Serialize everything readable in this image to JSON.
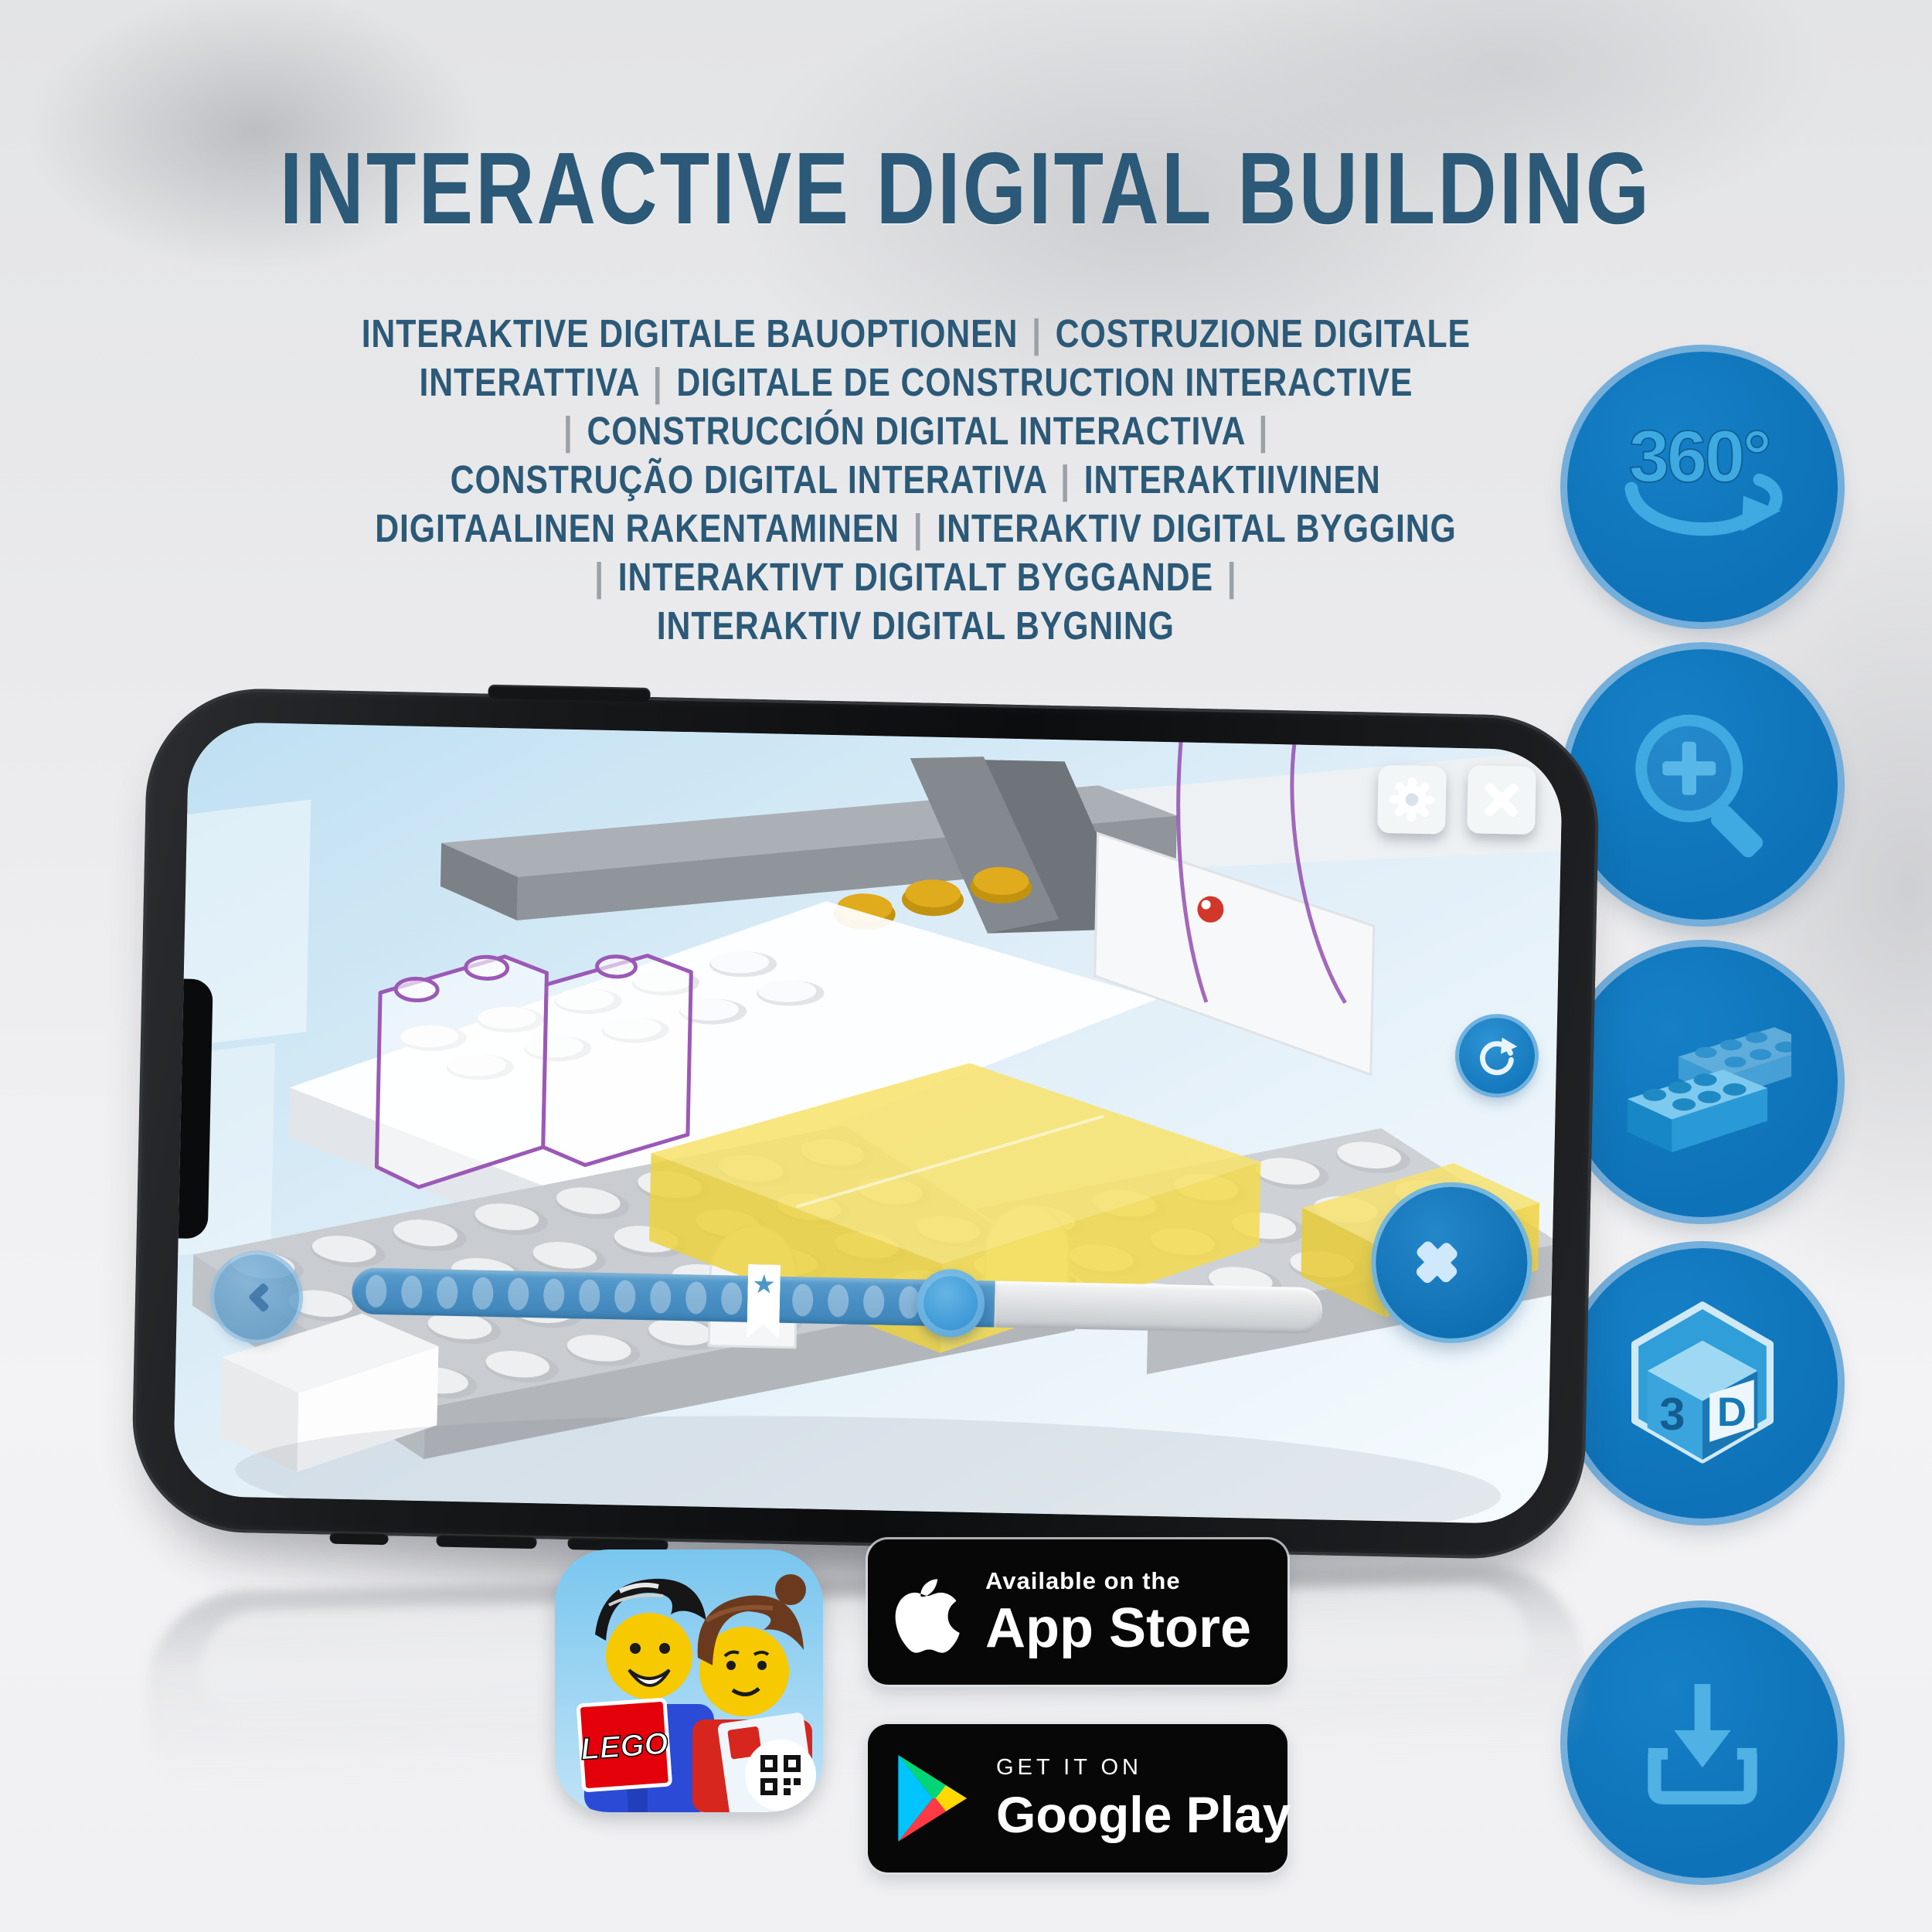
{
  "header": {
    "title": "INTERACTIVE DIGITAL BUILDING",
    "subtitle_lines": [
      "INTERAKTIVE DIGITALE BAUOPTIONEN | COSTRUZIONE DIGITALE",
      "INTERATTIVA | DIGITALE DE CONSTRUCTION INTERACTIVE",
      "| CONSTRUCCIÓN DIGITAL INTERACTIVA |",
      "CONSTRUÇÃO DIGITAL INTERATIVA | INTERAKTIIVINEN",
      "DIGITAALINEN RAKENTAMINEN | INTERAKTIV DIGITAL BYGGING",
      "| INTERAKTIVT DIGITALT BYGGANDE |",
      "INTERAKTIV DIGITAL BYGNING"
    ]
  },
  "feature_buttons": [
    {
      "name": "360-rotation",
      "text": "360°"
    },
    {
      "name": "zoom-in",
      "icon": "magnifier-plus-icon"
    },
    {
      "name": "brick-options",
      "icon": "lego-brick-icon"
    },
    {
      "name": "3d-view",
      "text_left": "3",
      "text_right": "D"
    },
    {
      "name": "download",
      "icon": "download-tray-icon"
    }
  ],
  "phone": {
    "screen": {
      "buttons": {
        "settings": "gear-icon",
        "close": "x-icon",
        "refresh": "circular-arrow-icon",
        "next": "chevron-right-icon",
        "back": "chevron-left-icon"
      },
      "slider": {
        "dot_count": 17,
        "star_glyph": "★"
      }
    }
  },
  "app_icon": {
    "logo_text": "LEGO"
  },
  "badges": {
    "app_store": {
      "tagline": "Available on the",
      "store": "App Store"
    },
    "google_play": {
      "tagline": "GET IT ON",
      "store": "Google Play"
    }
  },
  "colors": {
    "heading": "#2b5977",
    "separator": "#9aa2a8",
    "circle_fill": "#0e72b8",
    "circle_border": "#74aedb",
    "icon_blue": "#3fa9e1",
    "screen_sky": "#cfe6f4",
    "slider_blue": "#4a90c4",
    "knob_blue": "#3f9ad6",
    "brick_yellow": "#f2d64e",
    "ghost_purple": "#9b59b6",
    "badge_black": "#070708"
  }
}
